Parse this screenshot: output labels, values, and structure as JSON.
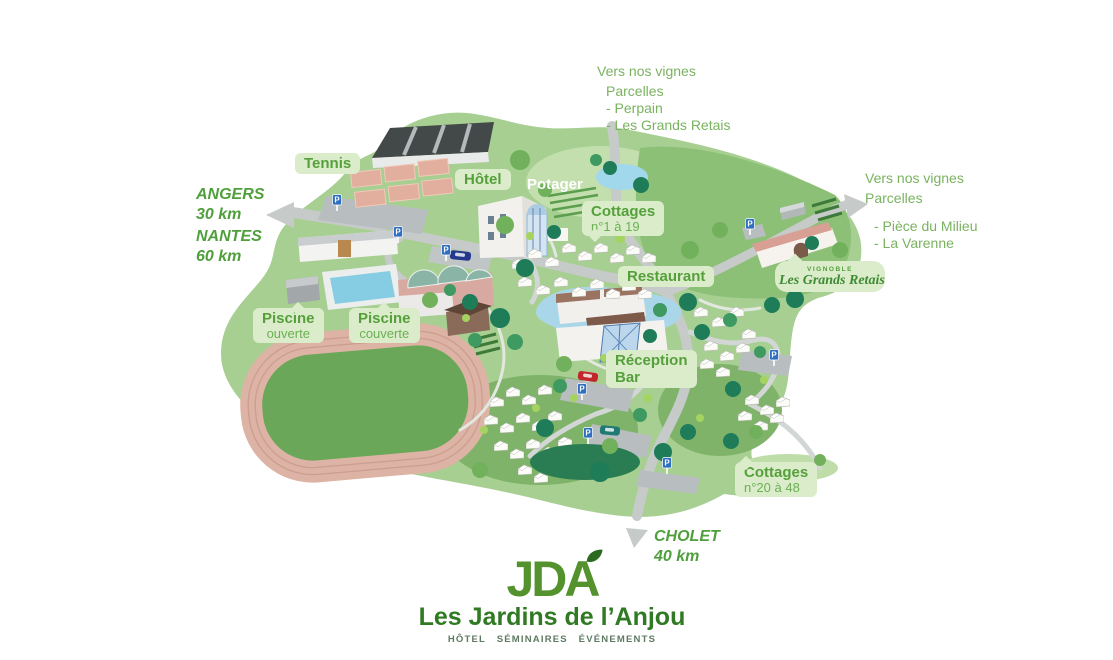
{
  "palette": {
    "label_bg": "#daecca",
    "label_text": "#56a03c",
    "label_text_light": "#6caf55",
    "annotation_green": "#7ab360",
    "distance_green": "#4f9f3c",
    "logo_green": "#54922d",
    "brand_green": "#2f7a22",
    "tagline_gray": "#5e7a62",
    "map_base": "#a7cf92",
    "map_light": "#bedda8",
    "map_medium": "#8dc077",
    "road_gray": "#c6cac9",
    "track_pink": "#dcb3a4",
    "water_blue": "#a9d7e9"
  },
  "annotations": {
    "vignes_top": {
      "title": "Vers nos vignes",
      "subtitle": "Parcelles",
      "items": [
        "- Perpain",
        "- Les Grands Retais"
      ]
    },
    "vignes_right": {
      "title": "Vers nos vignes",
      "subtitle": "Parcelles",
      "items": [
        "- Pièce du Milieu",
        "- La Varenne"
      ]
    },
    "angers": {
      "city": "ANGERS",
      "distance": "30 km"
    },
    "nantes": {
      "city": "NANTES",
      "distance": "60 km"
    },
    "cholet": {
      "city": "CHOLET",
      "distance": "40 km"
    }
  },
  "labels": {
    "tennis": "Tennis",
    "hotel": "Hôtel",
    "potager": "Potager",
    "cottages_north": {
      "line1": "Cottages",
      "line2": "n°1 à 19"
    },
    "restaurant": "Restaurant",
    "piscine_ouverte": {
      "line1": "Piscine",
      "line2": "ouverte"
    },
    "piscine_couverte": {
      "line1": "Piscine",
      "line2": "couverte"
    },
    "reception": {
      "line1": "Réception",
      "line2": "Bar"
    },
    "cottages_south": {
      "line1": "Cottages",
      "line2": "n°20 à 48"
    },
    "vignoble": {
      "line1": "VIGNOBLE",
      "line2": "Les Grands Retais"
    }
  },
  "map_icons": {
    "parking_letter": "P"
  },
  "footer_logo": {
    "acronym": "JDA",
    "name": "Les Jardins de l’Anjou",
    "tagline": "HÔTEL SÉMINAIRES ÉVÉNEMENTS"
  }
}
